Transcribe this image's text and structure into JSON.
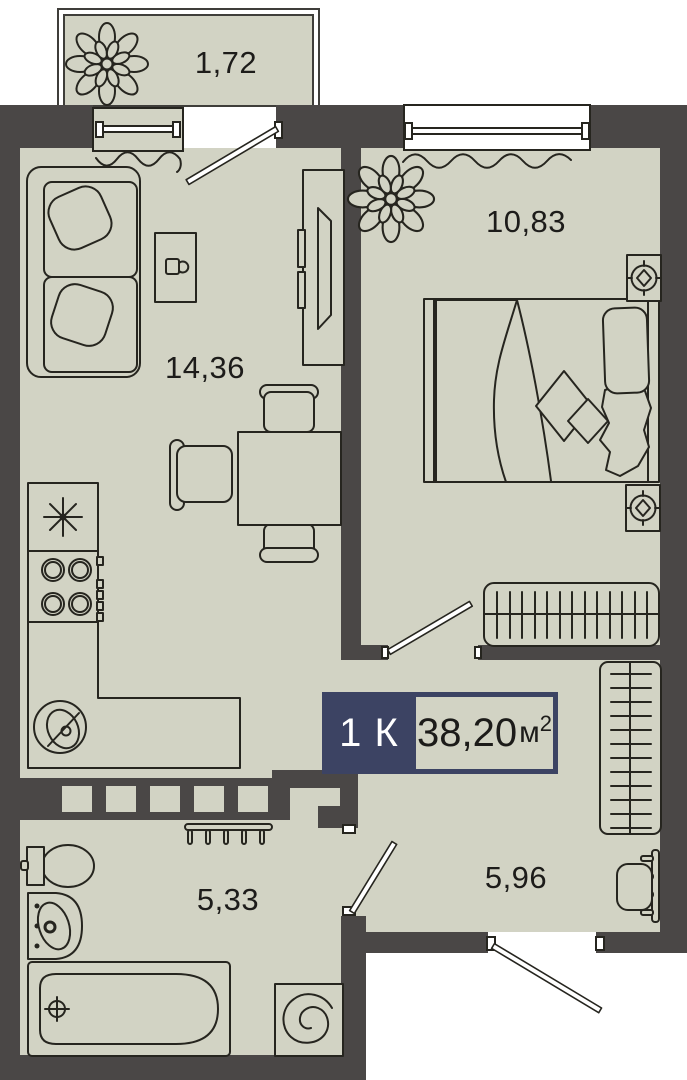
{
  "plan": {
    "badge": {
      "type_label": "1 К",
      "area_value": "38,20",
      "area_unit": "м",
      "area_exp": "2"
    },
    "rooms": {
      "balcony": {
        "area": "1,72"
      },
      "living_kitchen": {
        "area": "14,36"
      },
      "bedroom": {
        "area": "10,83"
      },
      "bathroom": {
        "area": "5,33"
      },
      "hallway": {
        "area": "5,96"
      }
    },
    "colors": {
      "wall": "#4a4746",
      "floor": "#d2d3c4",
      "line": "#26251f",
      "accent": "#3c4363",
      "paper": "#ffffff"
    }
  }
}
